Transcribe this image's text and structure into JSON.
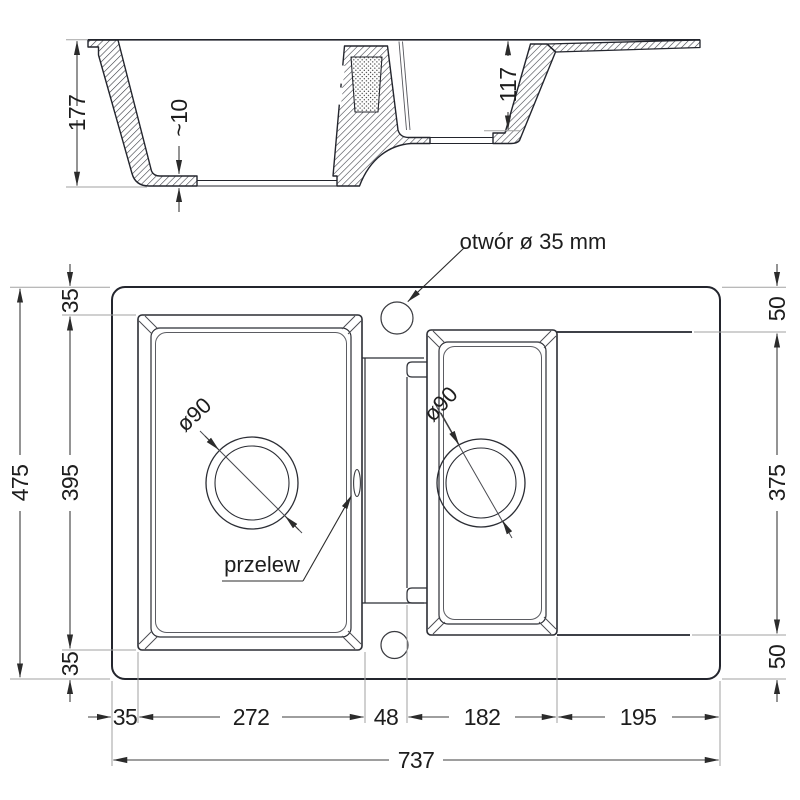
{
  "drawing_title": "kitchen sink technical drawing",
  "section_view": {
    "depth_main_bowl": "177",
    "bottom_thickness": "~10",
    "depth_second_bowl": "117"
  },
  "plan_view": {
    "annotations": {
      "tap_hole": "otwór ø 35 mm",
      "overflow": "przelew",
      "drain_main": "ø90",
      "drain_second": "ø90"
    },
    "vertical_left": {
      "total_height": "475",
      "bowl_height": "395",
      "top_margin": "35",
      "bottom_margin": "35"
    },
    "vertical_right": {
      "top_margin": "50",
      "bowl_height": "375",
      "bottom_margin": "50"
    },
    "horizontal": {
      "left_margin": "35",
      "main_bowl_width": "272",
      "gap": "48",
      "second_bowl_width": "182",
      "drainer_width": "195",
      "total_width": "737"
    }
  },
  "colors": {
    "line": "#23252d",
    "dim_line": "#3c3c3c",
    "extension_line": "#a2a2a2",
    "text": "#1d1d1d"
  }
}
